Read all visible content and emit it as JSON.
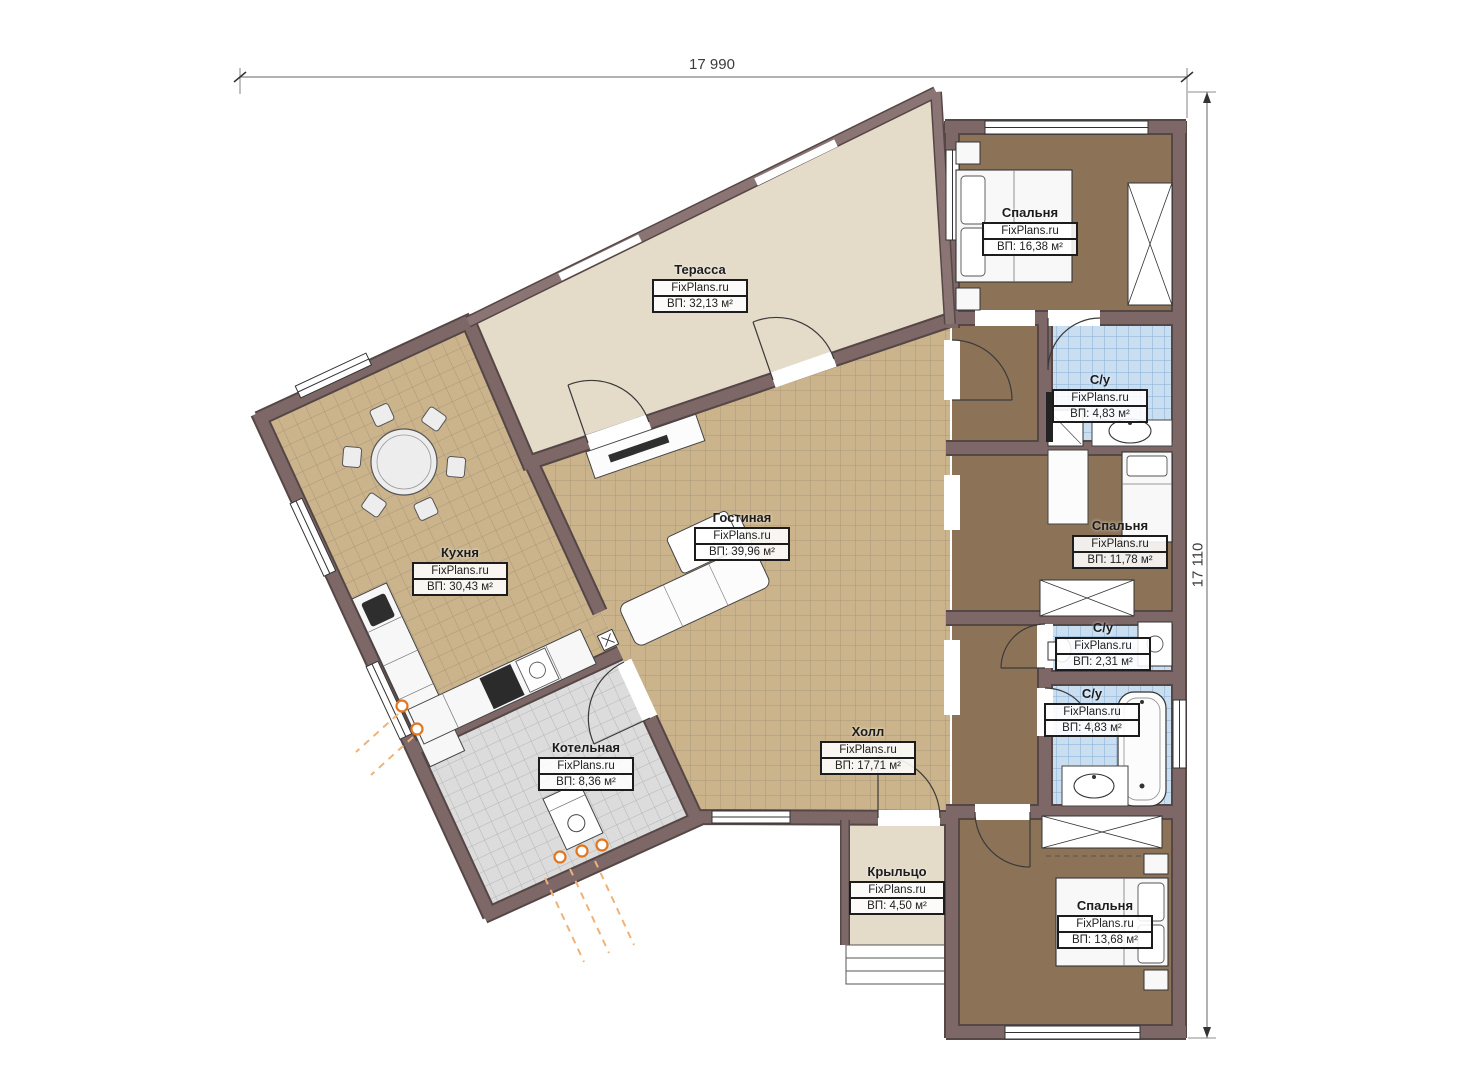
{
  "brand": "FixPlans.ru",
  "dimensions": {
    "width_label": "17 990",
    "height_label": "17 110"
  },
  "rooms": [
    {
      "id": "terrace",
      "name": "Терасса",
      "area": "ВП: 32,13 м²"
    },
    {
      "id": "bedroom-top",
      "name": "Спальня",
      "area": "ВП: 16,38 м²"
    },
    {
      "id": "bathroom-top",
      "name": "С/у",
      "area": "ВП: 4,83 м²"
    },
    {
      "id": "bedroom-middle",
      "name": "Спальня",
      "area": "ВП: 11,78 м²"
    },
    {
      "id": "bathroom-middle",
      "name": "С/у",
      "area": "ВП: 2,31 м²"
    },
    {
      "id": "bathroom-lower",
      "name": "С/у",
      "area": "ВП: 4,83 м²"
    },
    {
      "id": "kitchen",
      "name": "Кухня",
      "area": "ВП: 30,43 м²"
    },
    {
      "id": "living-room",
      "name": "Гостиная",
      "area": "ВП: 39,96 м²"
    },
    {
      "id": "hall",
      "name": "Холл",
      "area": "ВП: 17,71 м²"
    },
    {
      "id": "boiler-room",
      "name": "Котельная",
      "area": "ВП: 8,36 м²"
    },
    {
      "id": "porch",
      "name": "Крыльцо",
      "area": "ВП: 4,50 м²"
    },
    {
      "id": "bedroom-bottom",
      "name": "Спальня",
      "area": "ВП: 13,68 м²"
    }
  ],
  "colors": {
    "wall": "#7d6767",
    "wall_outline": "#564747",
    "tile_floor": "#cbb48b",
    "carpet_floor": "#8c7358",
    "bath_tile": "#c9def1",
    "boiler_floor": "#dcdcdc",
    "terrace_floor": "#e4dbc9",
    "accent_orange": "#e2761f"
  }
}
